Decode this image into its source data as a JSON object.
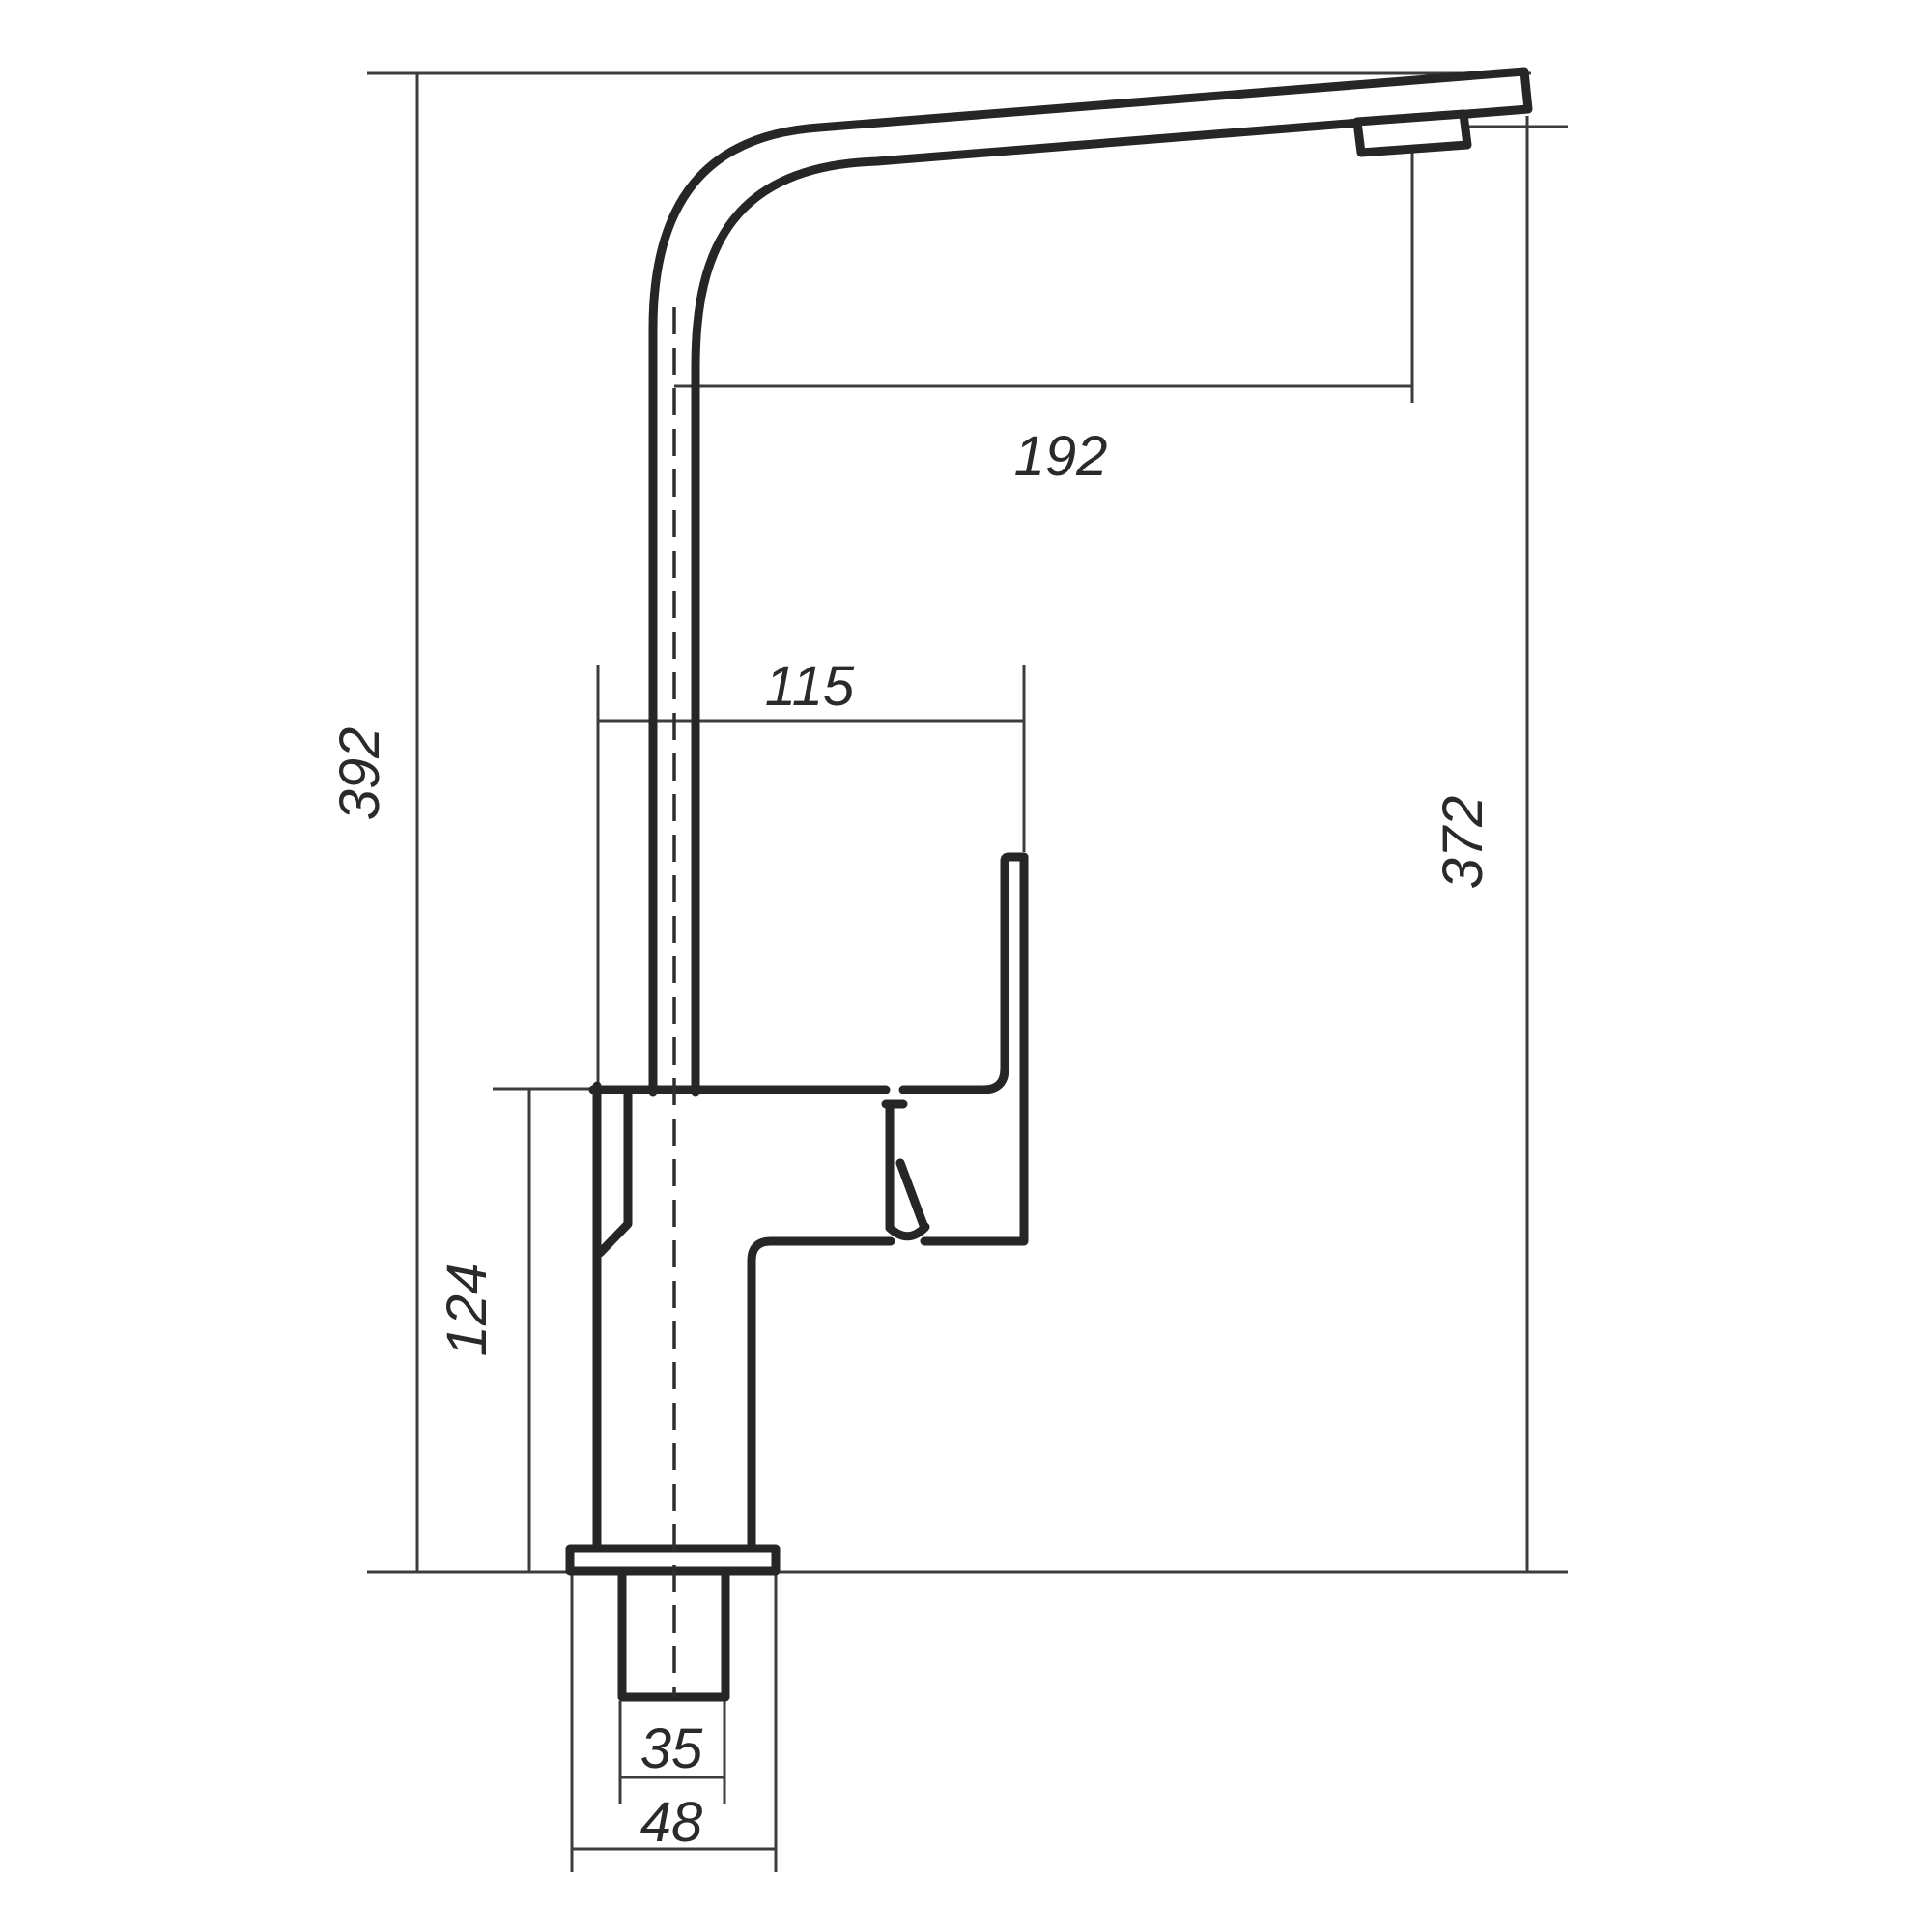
{
  "drawing": {
    "type": "technical-dimension-drawing",
    "subject": "single-lever kitchen faucet, side view",
    "background_color": "#ffffff",
    "line_color": "#262626",
    "dimension_line_color": "#3c3c3c",
    "dimensions": {
      "total_height": {
        "label": "392",
        "orientation": "vertical",
        "measures": "overall height from counter to spout top"
      },
      "spout_height": {
        "label": "372",
        "orientation": "vertical",
        "measures": "height from counter to aerator outlet"
      },
      "spout_reach": {
        "label": "192",
        "orientation": "horizontal",
        "measures": "reach from riser centerline to aerator centerline"
      },
      "body_depth": {
        "label": "115",
        "orientation": "horizontal",
        "measures": "body front-to-handle depth"
      },
      "body_height": {
        "label": "124",
        "orientation": "vertical",
        "measures": "body height above counter"
      },
      "shank_width": {
        "label": "35",
        "orientation": "horizontal",
        "measures": "threaded shank width"
      },
      "flange_width": {
        "label": "48",
        "orientation": "horizontal",
        "measures": "base flange width"
      }
    }
  }
}
